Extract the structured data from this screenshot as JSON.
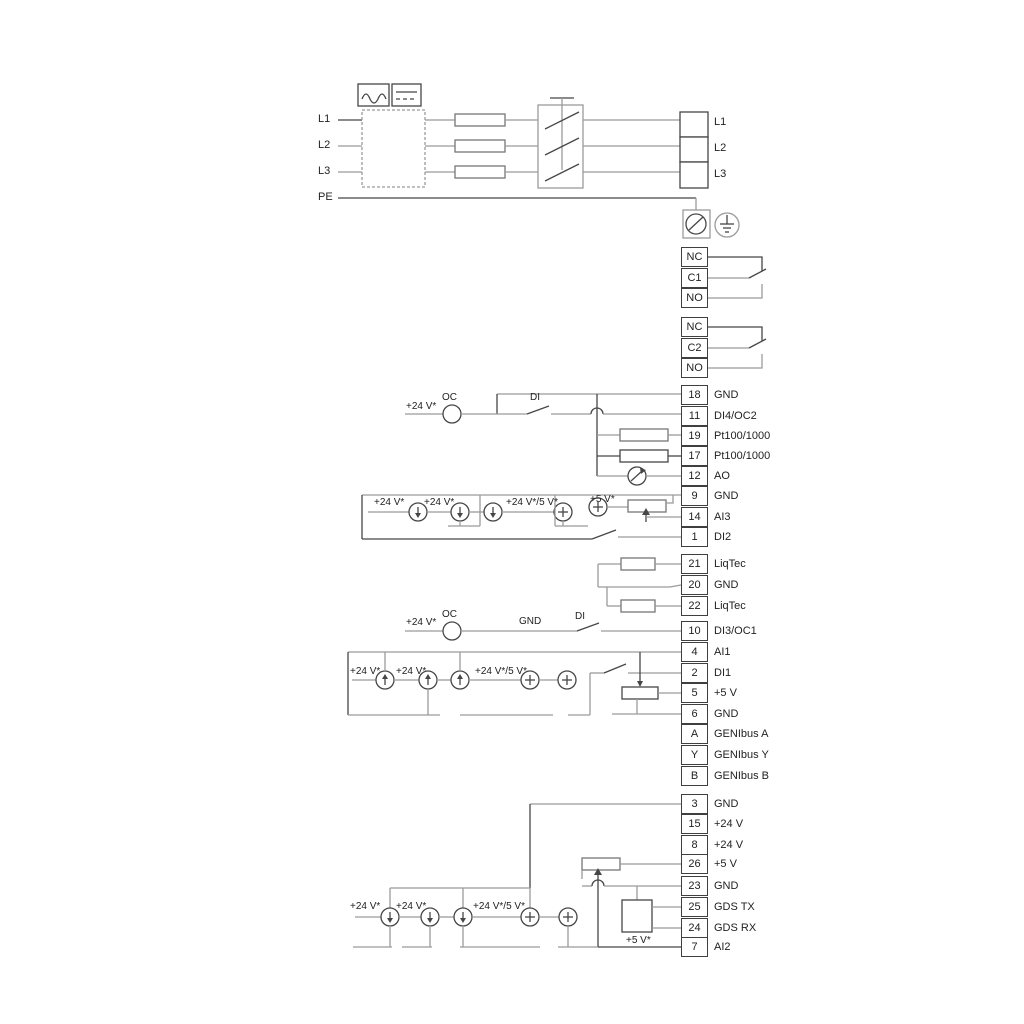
{
  "power_in": [
    "L1",
    "L2",
    "L3",
    "PE"
  ],
  "mains_out": [
    "L1",
    "L2",
    "L3"
  ],
  "relay1": [
    "NC",
    "C1",
    "NO"
  ],
  "relay2": [
    "NC",
    "C2",
    "NO"
  ],
  "terminals": [
    {
      "n": "18",
      "l": "GND"
    },
    {
      "n": "11",
      "l": "DI4/OC2"
    },
    {
      "n": "19",
      "l": "Pt100/1000"
    },
    {
      "n": "17",
      "l": "Pt100/1000"
    },
    {
      "n": "12",
      "l": "AO"
    },
    {
      "n": "9",
      "l": "GND"
    },
    {
      "n": "14",
      "l": "AI3"
    },
    {
      "n": "1",
      "l": "DI2"
    },
    {
      "n": "21",
      "l": "LiqTec"
    },
    {
      "n": "20",
      "l": "GND"
    },
    {
      "n": "22",
      "l": "LiqTec"
    },
    {
      "n": "10",
      "l": "DI3/OC1"
    },
    {
      "n": "4",
      "l": "AI1"
    },
    {
      "n": "2",
      "l": "DI1"
    },
    {
      "n": "5",
      "l": "+5 V"
    },
    {
      "n": "6",
      "l": "GND"
    },
    {
      "n": "A",
      "l": "GENIbus A"
    },
    {
      "n": "Y",
      "l": "GENIbus Y"
    },
    {
      "n": "B",
      "l": "GENIbus B"
    },
    {
      "n": "3",
      "l": "GND"
    },
    {
      "n": "15",
      "l": "+24 V"
    },
    {
      "n": "8",
      "l": "+24 V"
    },
    {
      "n": "26",
      "l": "+5 V"
    },
    {
      "n": "23",
      "l": "GND"
    },
    {
      "n": "25",
      "l": "GDS TX"
    },
    {
      "n": "24",
      "l": "GDS RX"
    },
    {
      "n": "7",
      "l": "AI2"
    }
  ],
  "ann": {
    "r18_24v": "+24 V*",
    "r18_oc": "OC",
    "r18_di": "DI",
    "ai3_24v_a": "+24 V*",
    "ai3_24v_b": "+24 V*",
    "ai3_mix": "+24 V*/5 V*",
    "ai3_5v": "+5 V*",
    "r10_24v": "+24 V*",
    "r10_oc": "OC",
    "r10_gnd": "GND",
    "r10_di": "DI",
    "ai1_24v_a": "+24 V*",
    "ai1_24v_b": "+24 V*",
    "ai1_mix": "+24 V*/5 V*",
    "bot_24v_a": "+24 V*",
    "bot_24v_b": "+24 V*",
    "bot_mix": "+24 V*/5 V*",
    "bot_5v": "+5 V*"
  },
  "colors": {
    "wire": "#9b9b9b",
    "dark": "#464646",
    "text": "#222222"
  }
}
